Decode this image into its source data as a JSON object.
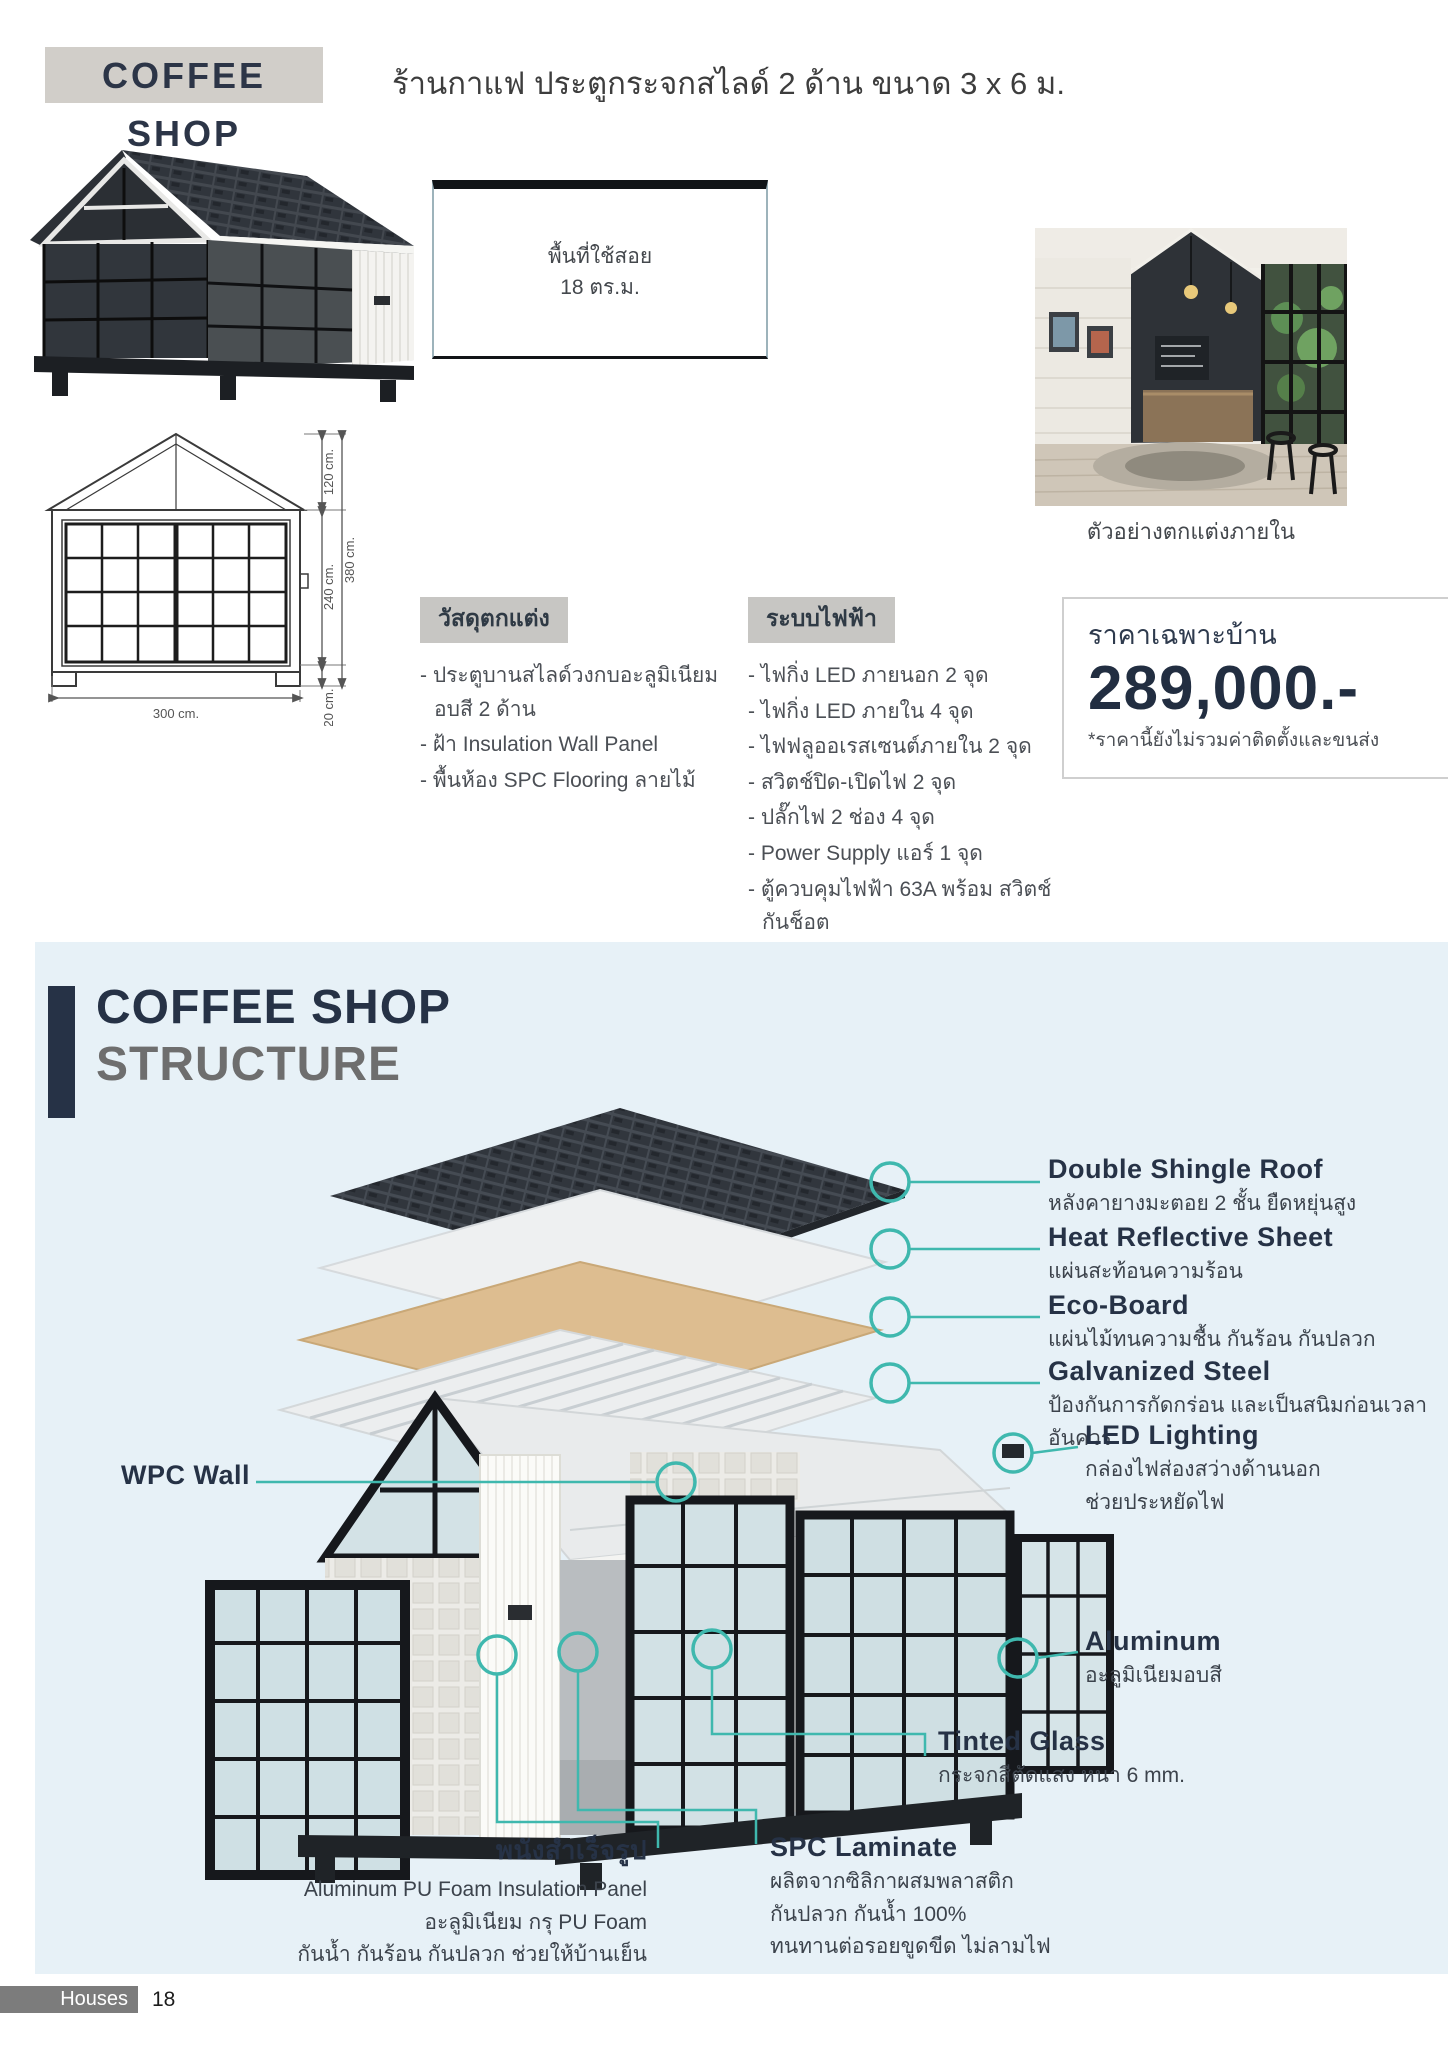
{
  "header": {
    "title": "COFFEE SHOP",
    "subtitle": "ร้านกาแฟ ประตูกระจกสไลด์ 2 ด้าน ขนาด 3 x 6 ม."
  },
  "floor_plan": {
    "line1": "พื้นที่ใช้สอย",
    "line2": "18 ตร.ม."
  },
  "interior_caption": "ตัวอย่างตกแต่งภายใน",
  "elevation": {
    "gable": "120 cm.",
    "wall": "240 cm.",
    "base": "20 cm.",
    "total": "380 cm.",
    "width": "300 cm."
  },
  "materials": {
    "title": "วัสดุตกแต่ง",
    "items": [
      "- ประตูบานสไลด์วงกบอะลูมิเนียมอบสี 2 ด้าน",
      "- ฝ้า Insulation Wall Panel",
      "- พื้นห้อง SPC Flooring ลายไม้"
    ]
  },
  "electrical": {
    "title": "ระบบไฟฟ้า",
    "items": [
      "- ไฟกิ่ง LED ภายนอก 2 จุด",
      "- ไฟกิ่ง LED ภายใน 4 จุด",
      "- ไฟฟลูออเรสเซนต์ภายใน 2 จุด",
      "- สวิตช์ปิด-เปิดไฟ 2 จุด",
      "- ปลั๊กไฟ 2 ช่อง 4 จุด",
      "- Power Supply แอร์ 1 จุด",
      "- ตู้ควบคุมไฟฟ้า 63A พร้อม สวิตช์กันช็อต",
      "- กล่องพักสายไฟ"
    ]
  },
  "price": {
    "label": "ราคาเฉพาะบ้าน",
    "value": "289,000.-",
    "note": "*ราคานี้ยังไม่รวมค่าติดตั้งและขนส่ง"
  },
  "structure": {
    "title_line1": "COFFEE SHOP",
    "title_line2": "STRUCTURE",
    "callouts": [
      {
        "name": "Double Shingle Roof",
        "desc": "หลังคายางมะตอย 2 ชั้น ยืดหยุ่นสูง"
      },
      {
        "name": "Heat Reflective Sheet",
        "desc": "แผ่นสะท้อนความร้อน"
      },
      {
        "name": "Eco-Board",
        "desc": "แผ่นไม้ทนความชื้น กันร้อน กันปลวก"
      },
      {
        "name": "Galvanized Steel",
        "desc": "ป้องกันการกัดกร่อน และเป็นสนิมก่อนเวลาอันควร"
      },
      {
        "name": "LED Lighting",
        "desc": "กล่องไฟส่องสว่างด้านนอก\nช่วยประหยัดไฟ"
      },
      {
        "name": "WPC Wall",
        "desc": ""
      },
      {
        "name": "Aluminum",
        "desc": "อะลูมิเนียมอบสี"
      },
      {
        "name": "Tinted Glass",
        "desc": "กระจกสีตัดแสง หนา 6 mm."
      },
      {
        "name": "พนังสำเร็จรูป",
        "desc": "Aluminum PU Foam Insulation Panel\nอะลูมิเนียม กรุ PU Foam\nกันน้ำ กันร้อน กันปลวก ช่วยให้บ้านเย็น"
      },
      {
        "name": "SPC Laminate",
        "desc": "ผลิตจากซิลิกาผสมพลาสติก\nกันปลวก กันน้ำ 100%\nทนทานต่อรอยขูดขีด ไม่ลามไฟ"
      }
    ]
  },
  "footer": {
    "label": "Houses",
    "page_number": "18"
  },
  "colors": {
    "navy": "#263246",
    "teal": "#3fb8ae",
    "section_bg": "#e7f1f7",
    "header_box_bg": "#d1cec9",
    "label_box_bg": "#c7c6c3",
    "footer_bg": "#7c7c7c"
  }
}
